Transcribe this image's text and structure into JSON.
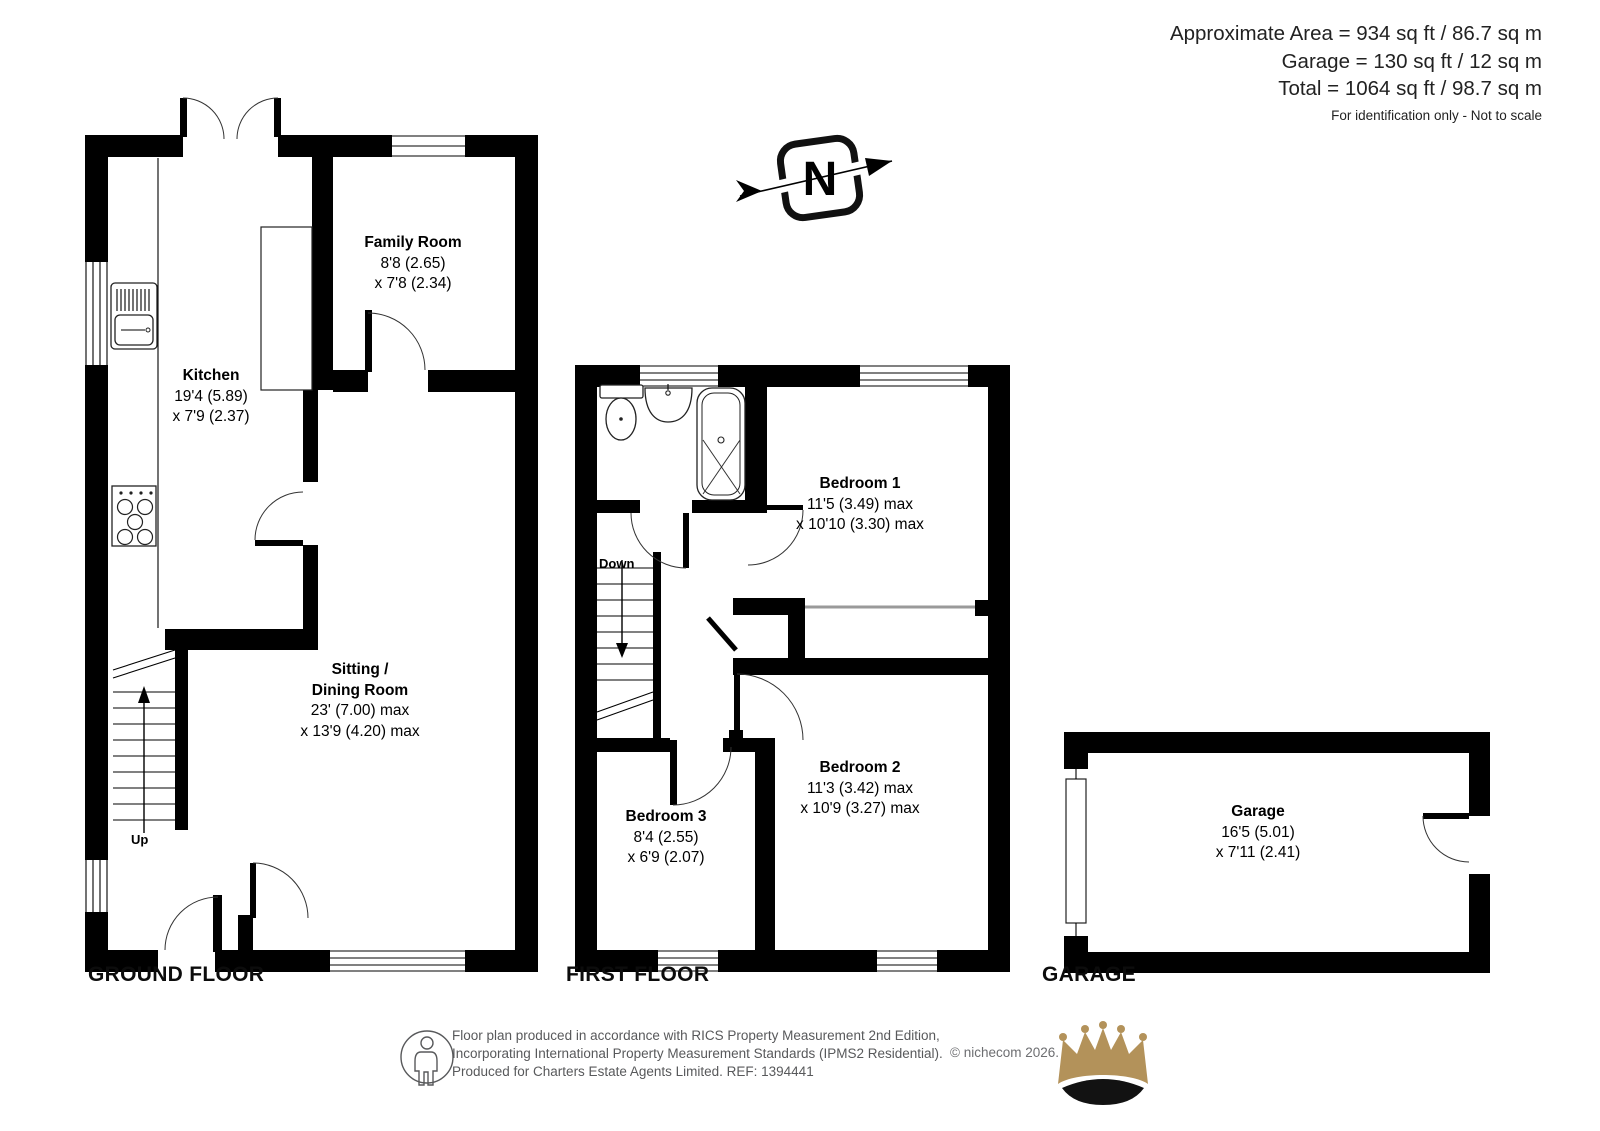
{
  "header": {
    "line1": "Approximate Area = 934 sq ft / 86.7 sq m",
    "line2": "Garage = 130 sq ft / 12 sq m",
    "line3": "Total = 1064 sq ft / 98.7 sq m",
    "note": "For identification only - Not to scale"
  },
  "compass": {
    "letter": "N"
  },
  "floors": {
    "ground": {
      "title": "GROUND FLOOR",
      "stairs_label": "Up",
      "rooms": {
        "kitchen": {
          "lines": [
            "Kitchen",
            "19'4 (5.89)",
            "x 7'9 (2.37)"
          ]
        },
        "family_room": {
          "lines": [
            "Family Room",
            "8'8 (2.65)",
            "x 7'8 (2.34)"
          ]
        },
        "sitting_dining": {
          "lines": [
            "Sitting /",
            "Dining Room",
            "23' (7.00) max",
            "x 13'9 (4.20) max"
          ]
        }
      }
    },
    "first": {
      "title": "FIRST FLOOR",
      "stairs_label": "Down",
      "rooms": {
        "bedroom1": {
          "lines": [
            "Bedroom 1",
            "11'5 (3.49) max",
            "x 10'10 (3.30) max"
          ]
        },
        "bedroom2": {
          "lines": [
            "Bedroom 2",
            "11'3 (3.42) max",
            "x 10'9 (3.27) max"
          ]
        },
        "bedroom3": {
          "lines": [
            "Bedroom 3",
            "8'4 (2.55)",
            "x 6'9 (2.07)"
          ]
        }
      }
    },
    "garage": {
      "title": "GARAGE",
      "rooms": {
        "garage": {
          "lines": [
            "Garage",
            "16'5 (5.01)",
            "x 7'11 (2.41)"
          ]
        }
      }
    }
  },
  "footer": {
    "line1": "Floor plan produced in accordance with RICS Property Measurement 2nd Edition,",
    "line2": "Incorporating International Property Measurement Standards (IPMS2 Residential).",
    "line3": "Produced for Charters Estate Agents Limited.   REF: 1394441",
    "copyright": "© nichecom 2026."
  },
  "colors": {
    "wall": "#000000",
    "crown_gold": "#B3925A",
    "text_gray": "#58595B"
  }
}
